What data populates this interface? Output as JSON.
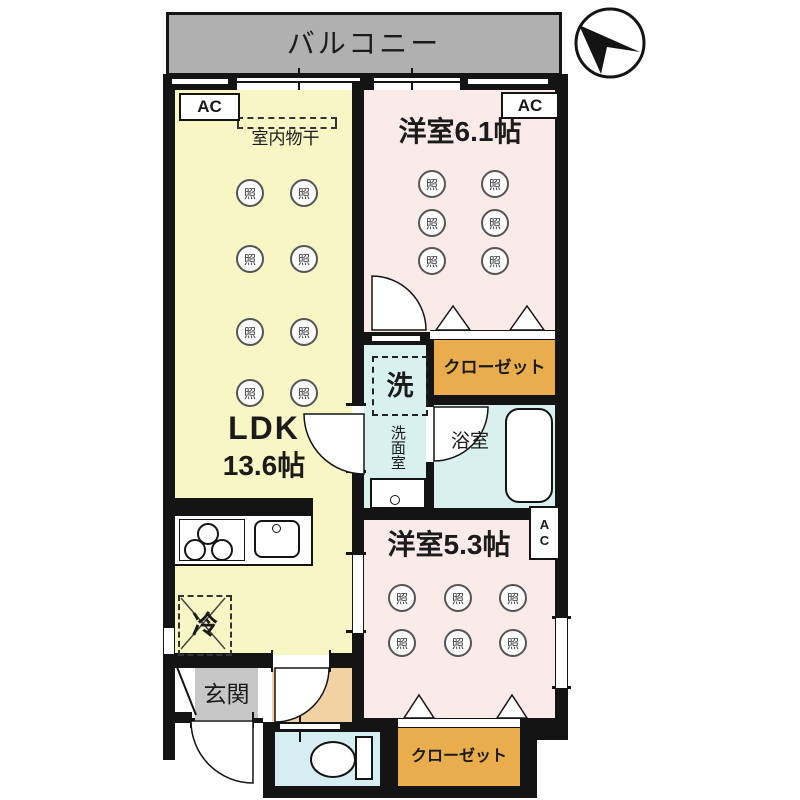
{
  "balcony": {
    "label": "バルコニー"
  },
  "rooms": {
    "ldk": {
      "name": "LDK",
      "size": "13.6帖"
    },
    "bedroom1": {
      "label": "洋室6.1帖"
    },
    "bedroom2": {
      "label": "洋室5.3帖"
    },
    "bathroom": {
      "label": "浴室"
    },
    "washroom": {
      "label": "洗面室",
      "washer": "洗"
    },
    "entrance": {
      "label": "玄関"
    },
    "closet1": {
      "label": "クローゼット"
    },
    "closet2": {
      "label": "クローゼット"
    }
  },
  "labels": {
    "ac": "AC",
    "drying": "室内物干",
    "fridge": "冷",
    "light": "照"
  },
  "colors": {
    "ldk_yellow": "#f9f6c5",
    "bedroom_pink": "#faeae8",
    "closet_orange": "#e9ad4e",
    "wet_blue": "#d9f1ee",
    "balcony_gray": "#b0b0b0",
    "entrance_gray": "#c7c7c7",
    "hall_peach": "#f2d2a2",
    "wall_black": "#141414"
  }
}
